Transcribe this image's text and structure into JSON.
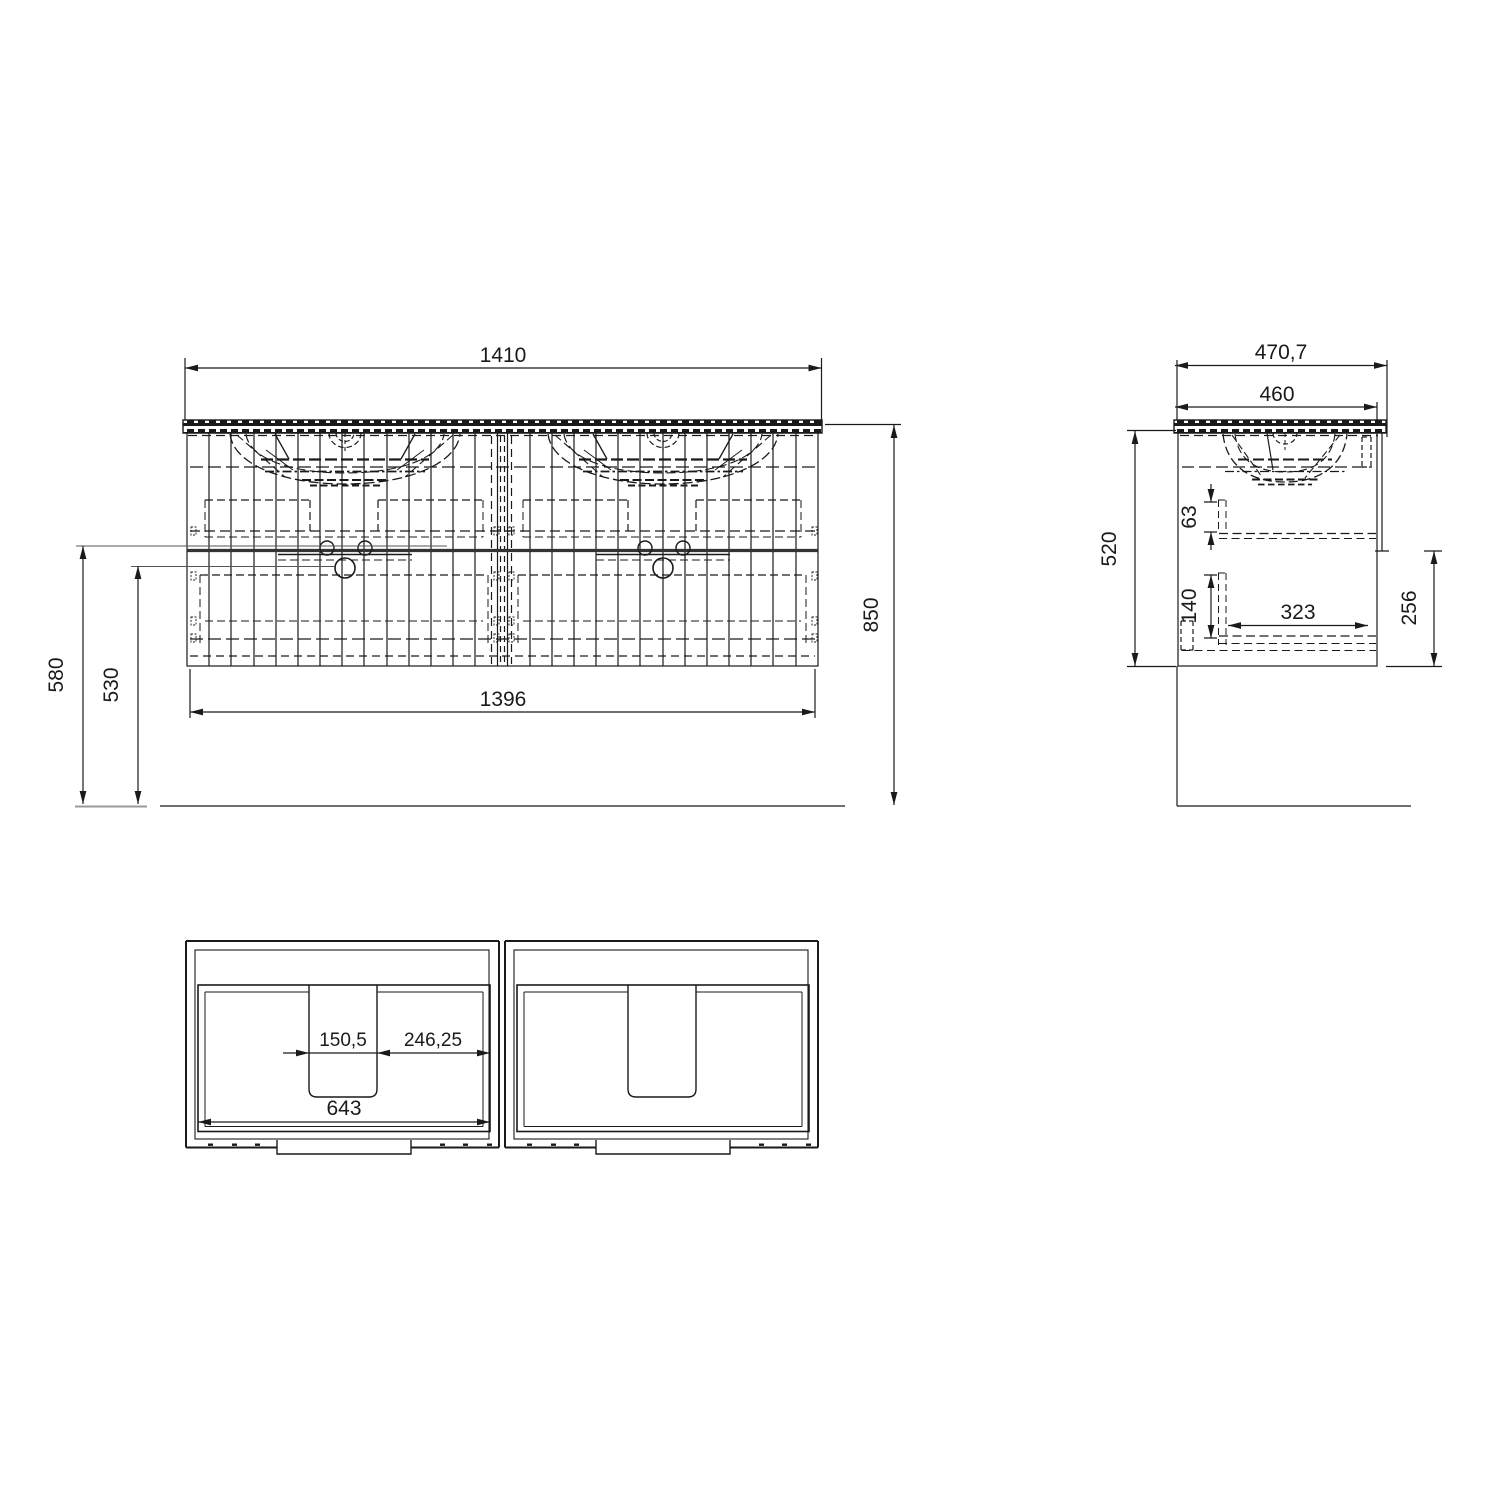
{
  "front": {
    "countertop_width": "1410",
    "body_width": "1396",
    "total_height": "850",
    "divider_height": "580",
    "drawer_top_height": "530"
  },
  "side": {
    "total_depth": "470,7",
    "countertop_depth": "460",
    "body_height": "520",
    "upper_gap": "63",
    "lower_gap": "140",
    "drawer_depth": "323",
    "lower_section_height": "256"
  },
  "plan": {
    "cutout_width": "150,5",
    "cutout_offset": "246,25",
    "inner_width": "643"
  },
  "colors": {
    "line": "#1a1a1a",
    "divider": "#333333",
    "leader": "#555555",
    "floor_stub": "#9a9a9a",
    "background": "#ffffff"
  }
}
